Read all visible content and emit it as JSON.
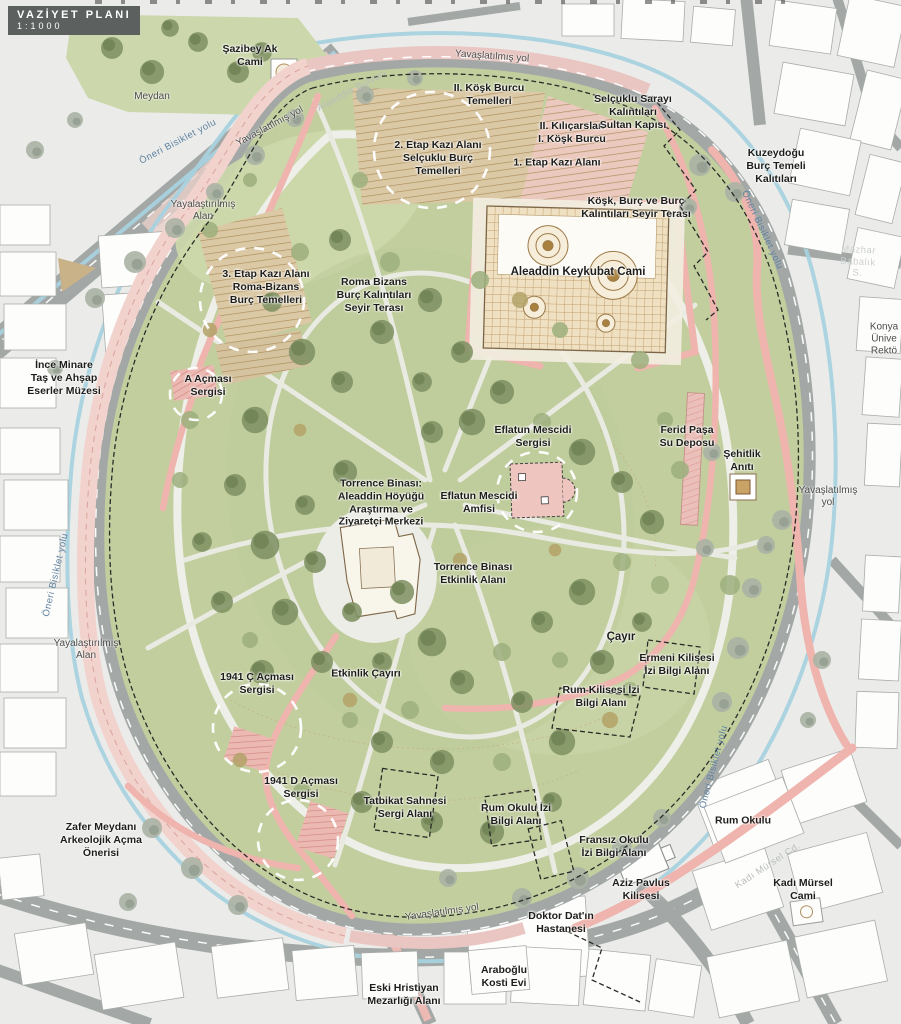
{
  "plan": {
    "title": "VAZİYET PLANI",
    "scale": "1:1000"
  },
  "colors": {
    "park_green": "#c2ce9e",
    "tree_dark": "#7f9263",
    "tree_light": "#9caf7c",
    "street_tree_gray": "#aab3a4",
    "road_gray": "#a3a8a6",
    "path_pink": "#eeb4ad",
    "excavation_tan": "#dbc9a6",
    "excavation_pink": "#ecb9b2",
    "water_blue": "#a8d2df",
    "building_white": "#fdfdfc",
    "label_text": "#1d1d1b",
    "title_bg": "#5c605e"
  },
  "labels": {
    "sazibey_ak_cami": "Şazibey Ak\nCami",
    "meydan": "Meydan",
    "kosk_burcu_2_temelleri": "II. Köşk Burcu\nTemelleri",
    "etap_2_kazi": "2. Etap Kazı Alanı\nSelçuklu Burç\nTemelleri",
    "kilicarslan_kosk": "II. Kılıçarslan\nI. Köşk Burcu",
    "etap_1_kazi": "1. Etap Kazı Alanı",
    "selcuklu_sarayi": "Selçuklu Sarayı\nKalıntıları\nSultan Kapısı",
    "kuzeydogu_burc": "Kuzeydoğu\nBurç Temeli\nKalıtıları",
    "kosk_burc_seyir": "Köşk, Burç ve Burç\nKalıntıları Seyir Terası",
    "yayalastirilmis_alan_kuzey": "Yayalaştırılmış\nAlan",
    "etap_3_kazi": "3. Etap Kazı Alanı\nRoma-Bizans\nBurç Temelleri",
    "roma_bizans_seyir": "Roma Bizans\nBurç Kalıntıları\nSeyir Terası",
    "aleaddin_keykubat_cami": "Aleaddin Keykubat Cami",
    "ince_minare_muzesi": "İnce Minare\nTaş ve Ahşap\nEserler Müzesi",
    "a_acmasi_sergisi": "A Açması\nSergisi",
    "eflatun_mescidi_sergisi": "Eflatun Mescidi\nSergisi",
    "ferid_pasa_su_deposu": "Ferid Paşa\nSu Deposu",
    "sehitlik_aniti": "Şehitlik\nAnıtı",
    "yavaslatilmis_yol_sag": "Yavaşlatılmış\nyol",
    "torrence_merkezi": "Torrence Binası:\nAleaddin Höyüğü\nAraştırma ve\nZiyaretçi Merkezi",
    "eflatun_mescidi_amfisi": "Eflatun Mescidi\nAmfisi",
    "torrence_etkinlik": "Torrence Binası\nEtkinlik Alanı",
    "cayir": "Çayır",
    "ermeni_kilisesi_izi": "Ermeni Kilisesi\nİzi Bilgi Alanı",
    "rum_kilisesi_izi": "Rum Kilisesi İzi\nBilgi Alanı",
    "c_acmasi_1941": "1941 Ç Açması\nSergisi",
    "etkinlik_cayiri": "Etkinlik Çayırı",
    "d_acmasi_1941": "1941 D Açması\nSergisi",
    "tatbikat_sahnesi": "Tatbikat Sahnesi\nSergi Alanı",
    "rum_okulu_izi": "Rum Okulu İzi\nBilgi Alanı",
    "fransiz_okulu_izi": "Fransız Okulu\nİzi Bilgi Alanı",
    "rum_okulu": "Rum Okulu",
    "zafer_meydani": "Zafer Meydanı\nArkeolojik Açma\nÖnerisi",
    "aziz_pavlus_kilisesi": "Aziz Pavlus\nKilisesi",
    "doktor_datin_hastanesi": "Doktor Dat'ın\nHastanesi",
    "kadi_mursel_cami": "Kadı Mürsel\nCami",
    "araboglu_kosti_evi": "Araboğlu\nKosti Evi",
    "eski_hristiyan_mezarligi": "Eski Hristiyan\nMezarlığı Alanı",
    "yayalastirilmis_alan_bati": "Yayalaştırılmış\nAlan",
    "konya_universitesi": "Konya\nÜnive\nRektö"
  },
  "street_labels": {
    "yavaslatilmis_yol": "Yavaşlatılmış yol",
    "oneri_bisiklet": "Öneri Bisiklet yolu",
    "alaeddin_bulvari": "Alaeddin Bulvarı",
    "mazhar_babalik": "Mazhar Babalık S.",
    "kadi_mursel_cd": "Kadı Mürsel Cd."
  }
}
